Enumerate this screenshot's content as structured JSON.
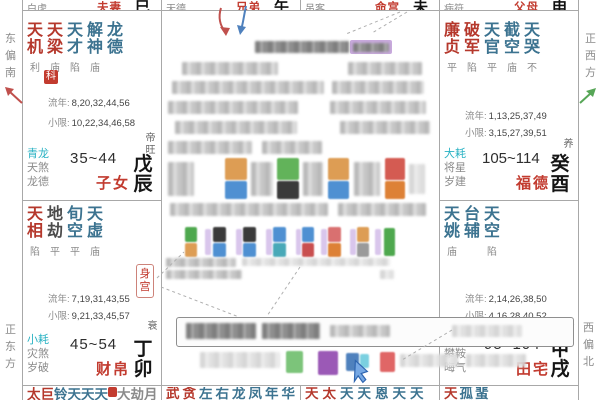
{
  "app": "ziwei-doushu-natal-chart",
  "labels": {
    "liunian": "流年:",
    "xiaoxian": "小限:"
  },
  "colors": {
    "palace_red": "#c23b2f",
    "star_red": "#b5382c",
    "star_blue": "#3c7390",
    "shensha_cyan": "#29b2c3",
    "text_gray": "#8b8b8b",
    "branch_black": "#151515",
    "arrow_red": "#c0504d",
    "arrow_blue": "#4f81bd",
    "arrow_green": "#57a657",
    "cursor_blue": "#3e74c4",
    "highlight_purple": "#c9aade",
    "grid_line": "#a8a8a8"
  },
  "directions": {
    "left_top": "东偏南",
    "left_bottom": "正东方",
    "right_top": "正西方",
    "right_bottom": "西偏北"
  },
  "top_row": [
    {
      "label": "白虎",
      "palace": "夫妻",
      "branch": "巳"
    },
    {
      "label": "天德",
      "palace": "兄弟",
      "branch": "午"
    },
    {
      "label": "吊客",
      "palace": "命宫",
      "branch": "未"
    },
    {
      "label": "病符",
      "palace": "父母",
      "branch": "申"
    }
  ],
  "palaces": {
    "zinv": {
      "stars": [
        {
          "name": "天机",
          "status": "利"
        },
        {
          "name": "天梁",
          "status": "庙"
        },
        {
          "name": "天才",
          "status": "陷"
        },
        {
          "name": "解神",
          "status": "庙"
        },
        {
          "name": "龙德",
          "status": ""
        }
      ],
      "badge": "科",
      "liunian": "8,20,32,44,56",
      "xiaoxian": "10,22,34,46,58",
      "shensha": {
        "a": "青龙",
        "b": "天煞",
        "c": "龙德"
      },
      "age": "35~44",
      "name": "子女",
      "zhangsheng": "帝旺",
      "branch": "戊辰"
    },
    "fude": {
      "stars": [
        {
          "name": "廉贞",
          "status": "平"
        },
        {
          "name": "破军",
          "status": "陷"
        },
        {
          "name": "天官",
          "status": "平"
        },
        {
          "name": "截空",
          "status": "庙"
        },
        {
          "name": "天哭",
          "status": "不"
        }
      ],
      "liunian": "1,13,25,37,49",
      "xiaoxian": "3,15,27,39,51",
      "shensha": {
        "a": "大耗",
        "b": "将星",
        "c": "岁建"
      },
      "age": "105~114",
      "name": "福德",
      "zhangsheng": "养",
      "branch": "癸酉"
    },
    "caibo": {
      "stars": [
        {
          "name": "天相",
          "status": "陷"
        },
        {
          "name": "地劫",
          "status": "平"
        },
        {
          "name": "旬空",
          "status": "平"
        },
        {
          "name": "天虚",
          "status": "庙"
        }
      ],
      "body_palace": "身宫",
      "liunian": "7,19,31,43,55",
      "xiaoxian": "9,21,33,45,57",
      "shensha": {
        "a": "小耗",
        "b": "灾煞",
        "c": "岁破"
      },
      "age": "45~54",
      "name": "财帛",
      "zhangsheng": "衰",
      "branch": "丁卯"
    },
    "tianzhai": {
      "stars": [
        {
          "name": "天姚",
          "status": "庙"
        },
        {
          "name": "台辅",
          "status": ""
        },
        {
          "name": "天空",
          "status": "陷"
        }
      ],
      "liunian": "2,14,26,38,50",
      "xiaoxian": "4,16,28,40,52",
      "shensha": {
        "a": "病符",
        "b": "攀鞍",
        "c": "晦气"
      },
      "age": "95~104",
      "name": "田宅",
      "zhangsheng": "胎",
      "branch": "甲戌"
    }
  },
  "bottom_row": [
    {
      "red": "太巨",
      "blue": "铃天天天",
      "gray": "大劫月"
    },
    {
      "red": "武贪",
      "blue": "左右龙凤年华",
      "gray": ""
    },
    {
      "red": "天太",
      "blue": "天天恩天天",
      "gray": ""
    },
    {
      "red": "天",
      "blue": "孤蜚",
      "gray": ""
    }
  ]
}
